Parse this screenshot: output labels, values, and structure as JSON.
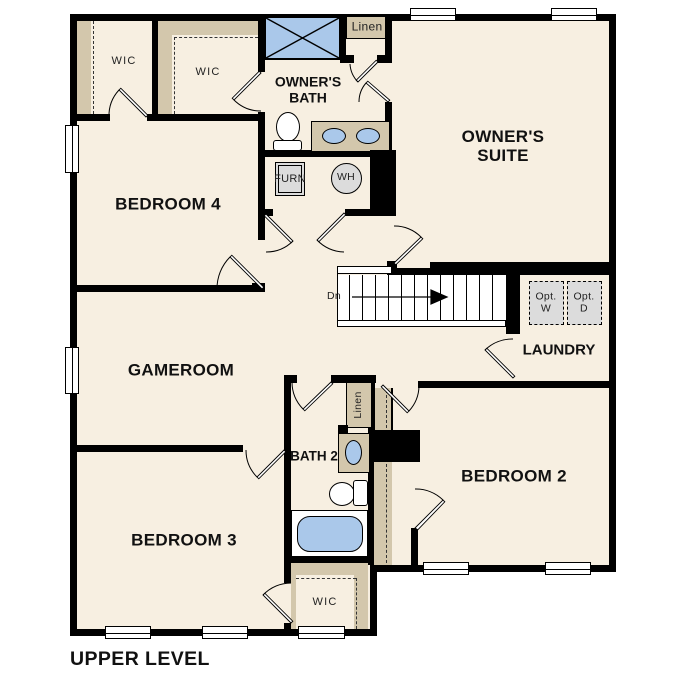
{
  "title": "UPPER LEVEL",
  "rooms": {
    "owners_suite": "OWNER'S SUITE",
    "owners_bath": "OWNER'S BATH",
    "bedroom4": "BEDROOM 4",
    "bedroom2": "BEDROOM 2",
    "bedroom3": "BEDROOM 3",
    "gameroom": "GAMEROOM",
    "laundry": "LAUNDRY",
    "bath2": "BATH 2"
  },
  "closets": {
    "wic_upper_left": "WIC",
    "wic_upper_mid": "WIC",
    "wic_lower": "WIC",
    "linen_upper": "Linen",
    "linen_lower": "Linen"
  },
  "utilities": {
    "furnace": "FURN",
    "water_heater": "WH",
    "opt_washer": "Opt. W",
    "opt_dryer": "Opt. D"
  },
  "stairs": {
    "direction": "Dn"
  },
  "colors": {
    "floor": "#f7efe1",
    "closet_fill": "#d3c7ac",
    "fixture_blue": "#aac8ea",
    "appliance_gray": "#dcdcdc",
    "wall": "#000000",
    "background": "#ffffff"
  }
}
